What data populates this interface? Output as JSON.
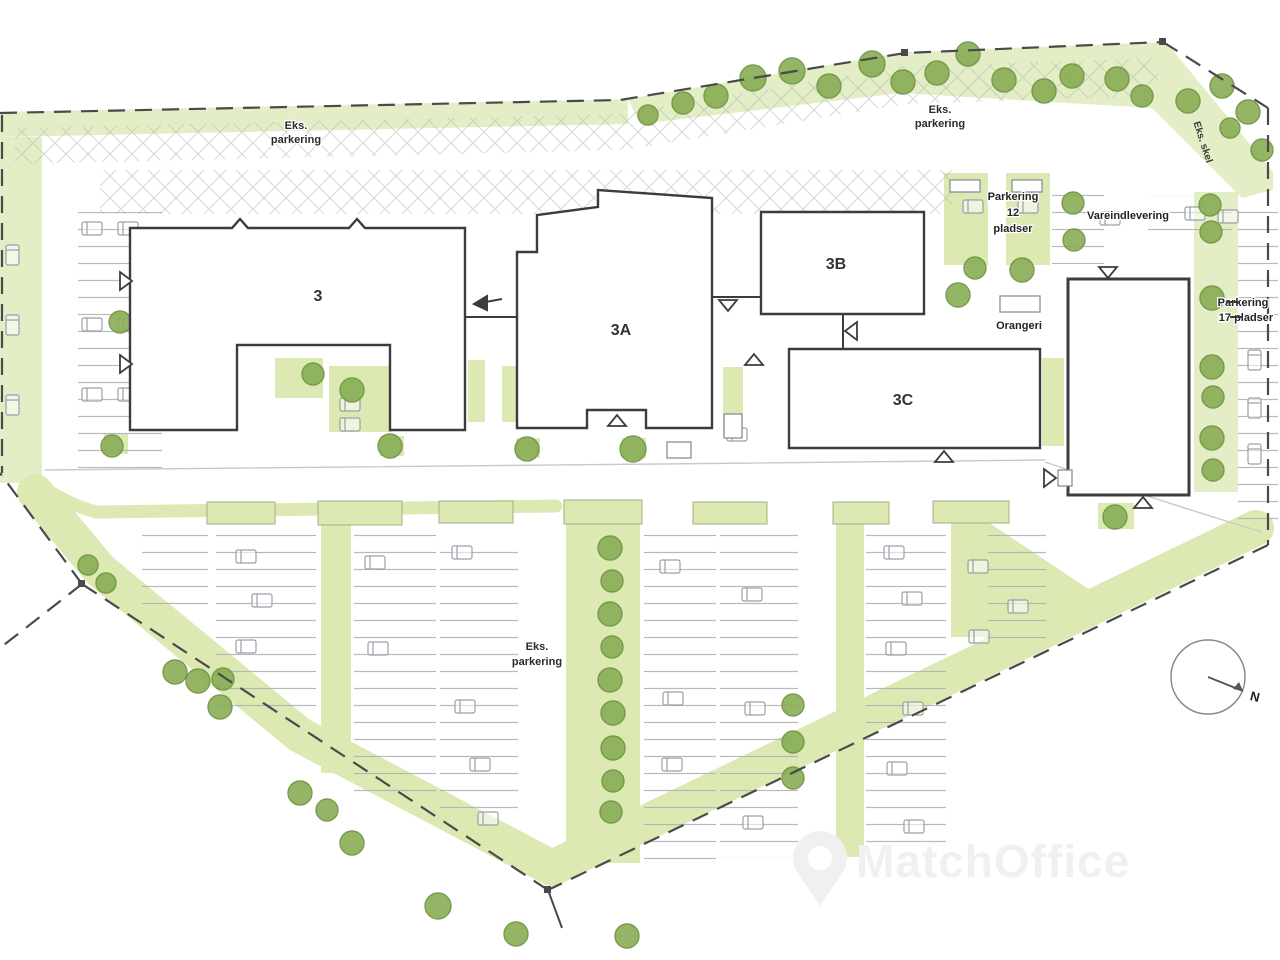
{
  "plan": {
    "buildings": {
      "b3": "3",
      "b3a": "3A",
      "b3b": "3B",
      "b3c": "3C"
    },
    "labels": {
      "eks_parkering_nw": {
        "l1": "Eks.",
        "l2": "parkering"
      },
      "eks_parkering_ne": {
        "l1": "Eks.",
        "l2": "parkering"
      },
      "eks_parkering_s": {
        "l1": "Eks.",
        "l2": "parkering"
      },
      "parkering_12": {
        "l1": "Parkering",
        "l2": "12",
        "l3": "pladser"
      },
      "vareindlevering": "Vareindlevering",
      "orangeri": "Orangeri",
      "parkering_17": {
        "l1": "Parkering",
        "l2": "17 pladser"
      },
      "eks_skel": "Eks. skel",
      "compass_n": "N"
    },
    "watermark": "MatchOffice",
    "colors": {
      "green_area": "#e4eec6",
      "green_strip": "#dce9b2",
      "tree": "#8aaf58",
      "tree_dark": "#6f9440",
      "outline": "#3c3c3c",
      "boundary": "#4a4a4a",
      "stall": "#a9aeb5",
      "watermark": "#f0f0f0"
    }
  }
}
